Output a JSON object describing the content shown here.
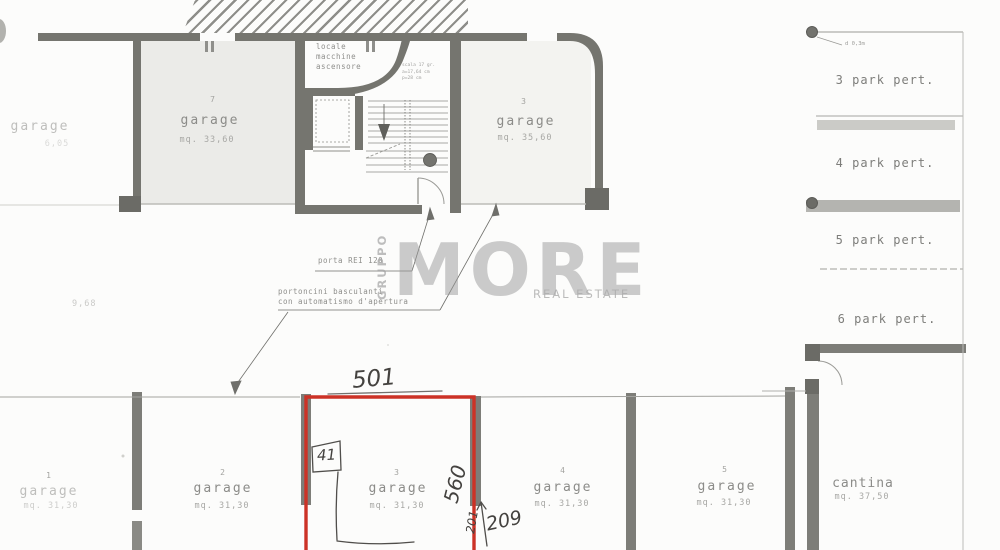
{
  "watermark": {
    "gruppo": "GRUPPO",
    "more": "MORE",
    "real_estate": "REAL ESTATE"
  },
  "upper": {
    "garage_left_fragment": {
      "label": "garage",
      "dim": "6,05"
    },
    "garage7": {
      "number": "7",
      "label": "garage",
      "area": "mq. 33,60"
    },
    "garage3": {
      "number": "3",
      "label": "garage",
      "area": "mq. 35,60"
    },
    "machine_room": [
      "locale",
      "macchine",
      "ascensore"
    ],
    "stair_note": [
      "scala 17 gr.",
      "a=17,64 cm",
      "p=28 cm"
    ]
  },
  "annotations": {
    "dim_968": "9,68",
    "porta": "porta REI 120",
    "portoncini": [
      "portoncini basculanti",
      "con automatismo d'apertura"
    ],
    "column_dia": "d 0,3m"
  },
  "handwriting": {
    "h501": "501",
    "h41": "41",
    "h560": "560",
    "h209": "209",
    "h201": "201"
  },
  "parking": {
    "slots": [
      "3 park pert.",
      "4 park pert.",
      "5 park pert.",
      "6 park pert."
    ]
  },
  "bottom": {
    "garages": [
      {
        "number": "1",
        "label": "garage",
        "area": "mq. 31,30"
      },
      {
        "number": "2",
        "label": "garage",
        "area": "mq. 31,30"
      },
      {
        "number": "3",
        "label": "garage",
        "area": "mq. 31,30"
      },
      {
        "number": "4",
        "label": "garage",
        "area": "mq. 31,30"
      },
      {
        "number": "5",
        "label": "garage",
        "area": "mq. 31,30"
      }
    ],
    "cantina": {
      "label": "cantina",
      "area": "mq. 37,50"
    }
  },
  "colors": {
    "highlight": "#cc3226",
    "wall": "#75756f",
    "pencil": "#44423f",
    "plan_text": "#8a8a8a"
  }
}
